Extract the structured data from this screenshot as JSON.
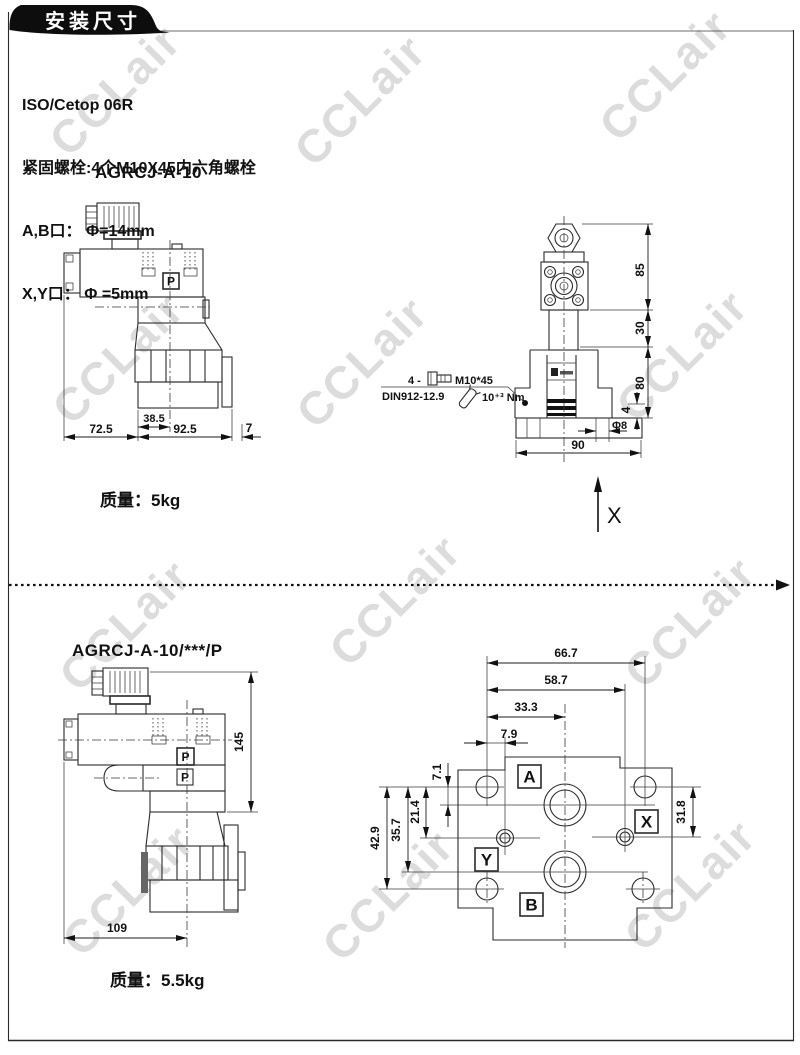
{
  "page": {
    "header_title": "安装尺寸",
    "watermark": "CCLair"
  },
  "specs": {
    "line1": "ISO/Cetop 06R",
    "line2": "紧固螺栓:4个M10X45内六角螺栓",
    "line3": "A,B口： Φ=14mm",
    "line4": "X,Y口： Φ =5mm"
  },
  "valve1": {
    "model": "AGRCJ-A-10",
    "mass": "质量：5kg",
    "side": {
      "p": "P",
      "d_inner": "38.5",
      "d_left": "72.5",
      "d_mid": "92.5",
      "d_right": "7"
    },
    "front": {
      "bolt_qty": "4 -",
      "bolt_spec": "M10*45",
      "din_note": "DIN912-12.9",
      "torque_note": "10⁺³ Nm",
      "dims": {
        "h1": "85",
        "h2": "30",
        "h3": "80",
        "h4": "4",
        "hole": "Φ8",
        "w": "90"
      },
      "axis": "X"
    }
  },
  "valve2": {
    "model": "AGRCJ-A-10/***/P",
    "mass": "质量：5.5kg",
    "side": {
      "p1": "P",
      "p2": "P",
      "d_height": "145",
      "d_width": "109"
    },
    "face": {
      "ports": {
        "a": "A",
        "x": "X",
        "y": "Y",
        "b": "B"
      },
      "dims": {
        "w1": "66.7",
        "w2": "58.7",
        "w3": "33.3",
        "w4": "7.9",
        "v1": "7.1",
        "v2": "21.4",
        "v3": "35.7",
        "v4": "42.9",
        "v5": "31.8"
      }
    }
  }
}
